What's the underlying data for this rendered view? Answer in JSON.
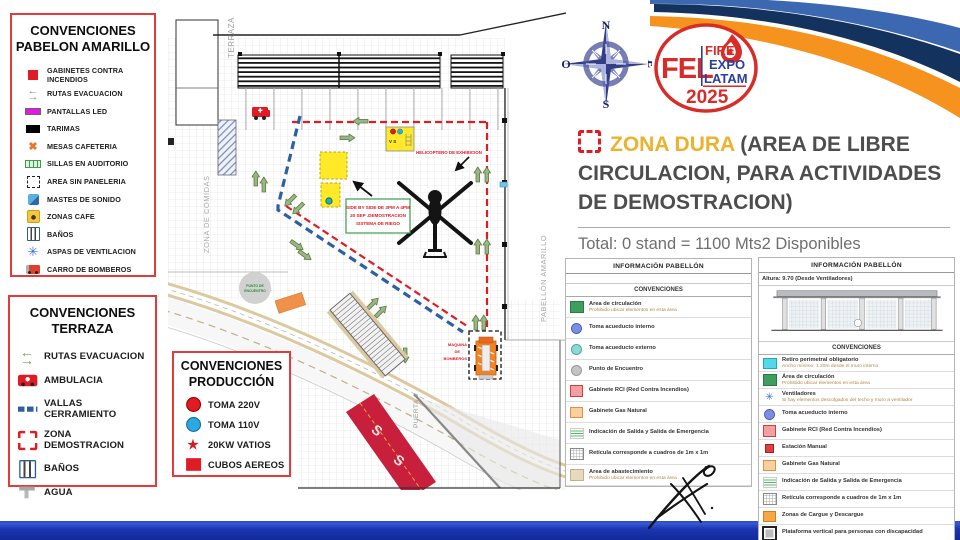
{
  "colors": {
    "accent_red": "#e01b24",
    "gold": "#ecb22e",
    "navy": "#14325e",
    "orange": "#f6921e",
    "bar_blue": "#1a36b0"
  },
  "legend_pabellon": {
    "title1": "CONVENCIONES",
    "title2": "PABELON AMARILLO",
    "items": [
      {
        "icon": "gabinete",
        "label": "GABINETES CONTRA INCENDIOS"
      },
      {
        "icon": "evac-arrows",
        "label": "RUTAS EVACUACION"
      },
      {
        "icon": "led-screen",
        "label": "PANTALLAS LED"
      },
      {
        "icon": "tarima",
        "label": "TARIMAS"
      },
      {
        "icon": "mesas-x",
        "label": "MESAS CAFETERIA"
      },
      {
        "icon": "sillas",
        "label": "SILLAS EN AUDITORIO"
      },
      {
        "icon": "area-dashed",
        "label": "AREA SIN PANELERIA"
      },
      {
        "icon": "mastes",
        "label": "MASTES DE SONIDO"
      },
      {
        "icon": "cafe",
        "label": "ZONAS CAFE"
      },
      {
        "icon": "banos",
        "label": "BAÑOS"
      },
      {
        "icon": "aspas",
        "label": "ASPAS DE VENTILACION"
      },
      {
        "icon": "firetruck",
        "label": "CARRO DE BOMBEROS"
      }
    ]
  },
  "legend_terraza": {
    "title1": "CONVENCIONES",
    "title2": "TERRAZA",
    "items": [
      {
        "icon": "evac-arrows",
        "label": "RUTAS EVACUACION"
      },
      {
        "icon": "ambulance",
        "label": "AMBULACIA"
      },
      {
        "icon": "vallas",
        "label": "VALLAS CERRAMIENTO"
      },
      {
        "icon": "zona-demo",
        "label": "ZONA DEMOSTRACION"
      },
      {
        "icon": "banos",
        "label": "BAÑOS"
      },
      {
        "icon": "agua",
        "label": "AGUA"
      }
    ]
  },
  "legend_produccion": {
    "title1": "CONVENCIONES",
    "title2": "PRODUCCIÓN",
    "items": [
      {
        "icon": "toma220",
        "label": "TOMA 220V"
      },
      {
        "icon": "toma110",
        "label": "TOMA 110V"
      },
      {
        "icon": "star20kw",
        "label": "20KW VATIOS"
      },
      {
        "icon": "cubos",
        "label": "CUBOS AEREOS"
      }
    ]
  },
  "compass": {
    "n": "N",
    "s": "S",
    "e": "E",
    "o": "O"
  },
  "logo": {
    "fel": "FEL",
    "fire": "FIRE",
    "expo": "EXPO",
    "latam": "LATAM",
    "year": "2025"
  },
  "zona_dura": {
    "highlight": "ZONA DURA",
    "rest": " (AREA DE LIBRE CIRCULACION, PARA ACTIVIDADES DE DEMOSTRACION)",
    "total": "Total: 0 stand = 1100 Mts2 Disponibles"
  },
  "map": {
    "terraza": "TERRAZA",
    "zona_comidas": "ZONA DE COMIDAS",
    "pabellon": "PABELLÓN AMARILLO",
    "puerta": "PUERTA 3",
    "helicoptero": "HELICOPTERO DE EXHIBICION",
    "side1": "SIDE BY SIDE DE 3PM A 4PM",
    "side2": "20 SEP .DEMOSTRACION",
    "side3": "SISTEMA DE RIEGO",
    "vs": "V S",
    "maq1": "MAQUINA",
    "maq2": "DE",
    "maq3": "BOMBEROS",
    "punto1": "PUNTO DE",
    "punto2": "ENCUENTRO",
    "s1": "S",
    "s2": "S"
  },
  "panel_left": {
    "title": "INFORMACIÓN PABELLÓN",
    "section": "CONVENCIONES",
    "rows": [
      {
        "icon": "green-square",
        "label": "Area de circulación",
        "sub": "Prohibido ubicar elementos en esta área"
      },
      {
        "icon": "blue-dot",
        "label": "Toma acueducto interno"
      },
      {
        "icon": "teal-dot",
        "label": "Toma acueducto externo"
      },
      {
        "icon": "gray-dot",
        "label": "Punto de Encuentro"
      },
      {
        "icon": "pink-square",
        "label": "Gabinete RCI (Red Contra Incendios)"
      },
      {
        "icon": "peach-square",
        "label": "Gabinete Gas Natural"
      },
      {
        "icon": "exit-sign",
        "label": "Indicación de Salida y Salida de Emergencia"
      },
      {
        "icon": "grid",
        "label": "Retícula corresponde a cuadros de 1m x 1m"
      },
      {
        "icon": "tan-square",
        "label": "Area de abastecimiento",
        "sub": "Prohibido ubicar elementos en esta área"
      }
    ]
  },
  "panel_right": {
    "title": "INFORMACIÓN PABELLÓN",
    "altura": "Altura: 9.70 (Desde Ventiladores)",
    "section": "CONVENCIONES",
    "rows": [
      {
        "icon": "cyan-square",
        "label": "Retiro perimetral obligatorio",
        "sub": "Ancho mínimo: 1.20m desde el muro interno"
      },
      {
        "icon": "green-square",
        "label": "Área de circulación",
        "sub": "Prohibido ubicar elementos en esta área"
      },
      {
        "icon": "fan",
        "label": "Ventiladores",
        "sub": "Si hay elementos descolgados del techo y muro a ventilador"
      },
      {
        "icon": "blue-dot",
        "label": "Toma acueducto interno"
      },
      {
        "icon": "pink-square",
        "label": "Gabinete RCI (Red Contra Incendios)"
      },
      {
        "icon": "red-mini",
        "label": "Estación Manual"
      },
      {
        "icon": "peach-square",
        "label": "Gabinete Gas Natural"
      },
      {
        "icon": "exit-sign",
        "label": "Indicación de Salida y Salida de Emergencia"
      },
      {
        "icon": "grid",
        "label": "Retícula corresponde a cuadros de 1m x 1m"
      },
      {
        "icon": "orange-square",
        "label": "Zonas de Cargue y Descargue"
      },
      {
        "icon": "platform",
        "label": "Plataforma vertical para personas con discapacidad"
      }
    ]
  }
}
